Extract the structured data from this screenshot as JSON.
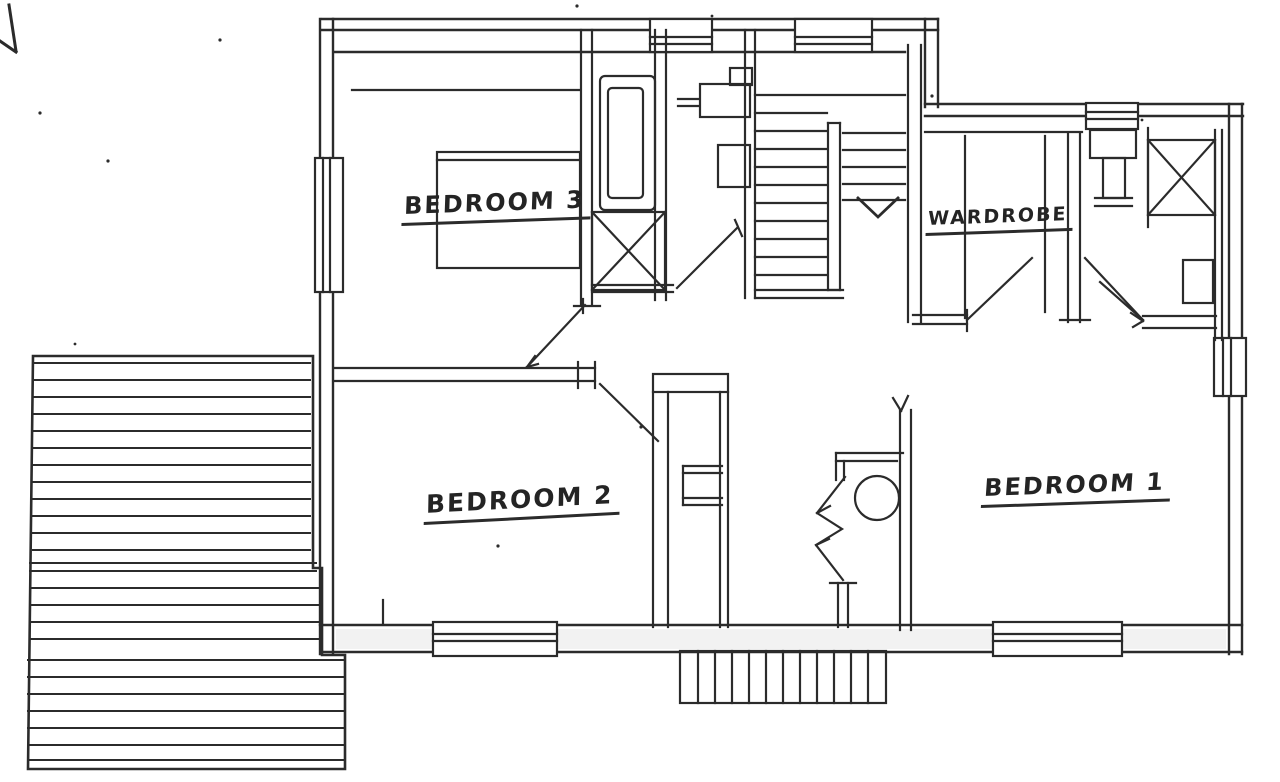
{
  "palette": {
    "paper": "#ffffff",
    "ink": "#2b2b2b"
  },
  "plan": {
    "rooms": [
      {
        "name": "bedroom-3",
        "label": "BEDROOM 3"
      },
      {
        "name": "wardrobe",
        "label": "WARDROBE"
      },
      {
        "name": "bedroom-2",
        "label": "BEDROOM 2"
      },
      {
        "name": "bedroom-1",
        "label": "BEDROOM 1"
      }
    ]
  }
}
